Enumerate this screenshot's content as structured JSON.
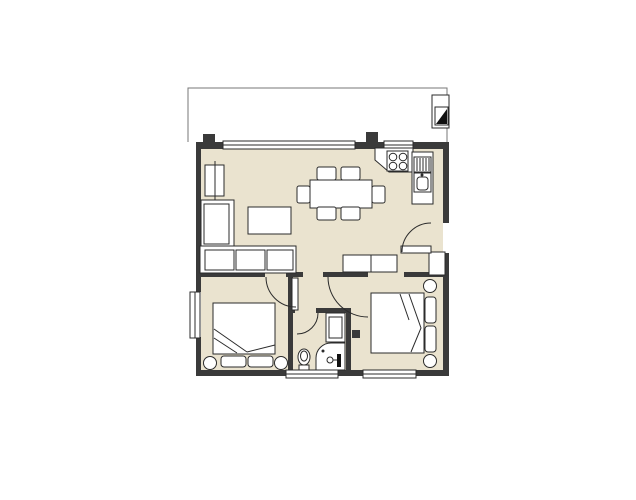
{
  "meta": {
    "type": "architectural-floor-plan",
    "rooms": [
      "living-dining-room",
      "kitchen",
      "hallway",
      "bedroom-left",
      "bedroom-right",
      "bathroom",
      "balcony"
    ]
  },
  "colors": {
    "floor": "#eae3cf",
    "wall": "#3a3a3a",
    "line": "#2b2b2b",
    "soft": "#777777",
    "white": "#ffffff",
    "dark": "#111111"
  },
  "canvas": {
    "width": 636,
    "height": 500
  },
  "elements": [
    {
      "name": "floor-living-dining",
      "type": "rect",
      "x": 201,
      "y": 148,
      "w": 242,
      "h": 124,
      "fill": "floor"
    },
    {
      "name": "floor-hallway",
      "type": "rect",
      "x": 293,
      "y": 272,
      "w": 75,
      "h": 41,
      "fill": "floor"
    },
    {
      "name": "floor-door-gap-bedleft",
      "type": "rect",
      "x": 265,
      "y": 272,
      "w": 23,
      "h": 5,
      "fill": "floor"
    },
    {
      "name": "floor-door-gap-bedright",
      "type": "rect",
      "x": 368,
      "y": 272,
      "w": 36,
      "h": 5,
      "fill": "floor"
    },
    {
      "name": "floor-bedroom-left",
      "type": "rect",
      "x": 201,
      "y": 277,
      "w": 87,
      "h": 93,
      "fill": "floor"
    },
    {
      "name": "floor-bathroom",
      "type": "rect",
      "x": 293,
      "y": 308,
      "w": 53,
      "h": 62,
      "fill": "floor"
    },
    {
      "name": "floor-bedroom-right",
      "type": "rect",
      "x": 348,
      "y": 277,
      "w": 95,
      "h": 93,
      "fill": "floor"
    },
    {
      "name": "balcony-floor",
      "type": "rect",
      "x": 187,
      "y": 87,
      "w": 261,
      "h": 56,
      "fill": "white"
    },
    {
      "name": "balcony-outline",
      "type": "path",
      "d": "M188,142 L188,88 L447,88 L447,142",
      "stroke": "soft"
    },
    {
      "name": "wall-top-left",
      "type": "rect",
      "x": 196,
      "y": 142,
      "w": 27,
      "h": 7,
      "fill": "wall"
    },
    {
      "name": "wall-top-mid",
      "type": "rect",
      "x": 355,
      "y": 142,
      "w": 30,
      "h": 7,
      "fill": "wall"
    },
    {
      "name": "wall-top-right",
      "type": "rect",
      "x": 412,
      "y": 142,
      "w": 37,
      "h": 7,
      "fill": "wall"
    },
    {
      "name": "wall-pier-top-left",
      "type": "rect",
      "x": 203,
      "y": 134,
      "w": 12,
      "h": 8,
      "fill": "wall"
    },
    {
      "name": "wall-balcony-divider",
      "type": "rect",
      "x": 366,
      "y": 132,
      "w": 12,
      "h": 10,
      "fill": "wall"
    },
    {
      "name": "wall-left-upper",
      "type": "rect",
      "x": 196,
      "y": 142,
      "w": 5,
      "h": 150,
      "fill": "wall"
    },
    {
      "name": "wall-left-lower",
      "type": "rect",
      "x": 196,
      "y": 337,
      "w": 5,
      "h": 39,
      "fill": "wall"
    },
    {
      "name": "wall-bottom-1",
      "type": "rect",
      "x": 196,
      "y": 370,
      "w": 90,
      "h": 6,
      "fill": "wall"
    },
    {
      "name": "wall-bottom-2",
      "type": "rect",
      "x": 338,
      "y": 370,
      "w": 25,
      "h": 6,
      "fill": "wall"
    },
    {
      "name": "wall-bottom-3",
      "type": "rect",
      "x": 416,
      "y": 370,
      "w": 33,
      "h": 6,
      "fill": "wall"
    },
    {
      "name": "wall-right-upper",
      "type": "rect",
      "x": 443,
      "y": 142,
      "w": 6,
      "h": 81,
      "fill": "wall"
    },
    {
      "name": "wall-right-lower",
      "type": "rect",
      "x": 443,
      "y": 253,
      "w": 6,
      "h": 123,
      "fill": "wall"
    },
    {
      "name": "wall-under-sofa",
      "type": "rect",
      "x": 198,
      "y": 272,
      "w": 67,
      "h": 5,
      "fill": "wall"
    },
    {
      "name": "wall-stub-center",
      "type": "rect",
      "x": 286,
      "y": 272,
      "w": 17,
      "h": 5,
      "fill": "wall"
    },
    {
      "name": "wall-bedleft-east",
      "type": "rect",
      "x": 288,
      "y": 277,
      "w": 5,
      "h": 99,
      "fill": "wall"
    },
    {
      "name": "wall-hall-south",
      "type": "rect",
      "x": 323,
      "y": 272,
      "w": 45,
      "h": 5,
      "fill": "wall"
    },
    {
      "name": "wall-hall-south-right",
      "type": "rect",
      "x": 404,
      "y": 272,
      "w": 45,
      "h": 5,
      "fill": "wall"
    },
    {
      "name": "wall-bath-top",
      "type": "rect",
      "x": 316,
      "y": 308,
      "w": 35,
      "h": 5,
      "fill": "wall"
    },
    {
      "name": "wall-bath-east",
      "type": "rect",
      "x": 346,
      "y": 308,
      "w": 5,
      "h": 68,
      "fill": "wall"
    },
    {
      "name": "wall-bath-stub",
      "type": "rect",
      "x": 288,
      "y": 304,
      "w": 7,
      "h": 9,
      "fill": "wall"
    },
    {
      "name": "wall-switch-mark",
      "type": "rect",
      "x": 352,
      "y": 330,
      "w": 8,
      "h": 8,
      "fill": "wall"
    },
    {
      "name": "window-balcony-main",
      "type": "rect",
      "x": 223,
      "y": 141,
      "w": 132,
      "h": 8,
      "fill": "white",
      "stroke": "line"
    },
    {
      "name": "window-balcony-main-midline",
      "type": "line",
      "x1": 223,
      "y1": 145,
      "x2": 355,
      "y2": 145,
      "stroke": "line"
    },
    {
      "name": "window-balcony-kitchen",
      "type": "rect",
      "x": 384,
      "y": 141,
      "w": 29,
      "h": 8,
      "fill": "white",
      "stroke": "line"
    },
    {
      "name": "window-balcony-kitchen-midline",
      "type": "line",
      "x1": 384,
      "y1": 145,
      "x2": 413,
      "y2": 145,
      "stroke": "line"
    },
    {
      "name": "window-bedleft-west",
      "type": "rect",
      "x": 190,
      "y": 292,
      "w": 10,
      "h": 46,
      "fill": "white",
      "stroke": "line"
    },
    {
      "name": "window-bedleft-west-midline",
      "type": "line",
      "x1": 195,
      "y1": 292,
      "x2": 195,
      "y2": 338,
      "stroke": "line"
    },
    {
      "name": "window-bath-south",
      "type": "rect",
      "x": 286,
      "y": 370,
      "w": 52,
      "h": 8,
      "fill": "white",
      "stroke": "line"
    },
    {
      "name": "window-bath-south-midline",
      "type": "line",
      "x1": 286,
      "y1": 374,
      "x2": 338,
      "y2": 374,
      "stroke": "line"
    },
    {
      "name": "window-bedright-south",
      "type": "rect",
      "x": 363,
      "y": 370,
      "w": 53,
      "h": 8,
      "fill": "white",
      "stroke": "line"
    },
    {
      "name": "window-bedright-south-midline",
      "type": "line",
      "x1": 363,
      "y1": 374,
      "x2": 416,
      "y2": 374,
      "stroke": "line"
    },
    {
      "name": "shaft-box",
      "type": "rect",
      "x": 432,
      "y": 95,
      "w": 17,
      "h": 33,
      "fill": "white",
      "stroke": "line"
    },
    {
      "name": "shaft-inner",
      "type": "rect",
      "x": 435,
      "y": 107,
      "w": 13,
      "h": 18,
      "fill": "white",
      "stroke": "line"
    },
    {
      "name": "shaft-triangle",
      "type": "polygon",
      "points": "436,124 447,124 447,109",
      "fill": "dark"
    },
    {
      "name": "kitchen-counter-top",
      "type": "polygon",
      "points": "375,148 413,148 413,172 389,172 375,160",
      "fill": "white",
      "stroke": "line"
    },
    {
      "name": "stove",
      "type": "rect",
      "x": 387,
      "y": 151,
      "w": 21,
      "h": 20,
      "fill": "white",
      "stroke": "line"
    },
    {
      "name": "stove-burner-1",
      "type": "circle",
      "cx": 393,
      "cy": 157,
      "r": 3.8,
      "stroke": "line"
    },
    {
      "name": "stove-burner-2",
      "type": "circle",
      "cx": 403,
      "cy": 157,
      "r": 3.8,
      "stroke": "line"
    },
    {
      "name": "stove-burner-3",
      "type": "circle",
      "cx": 393,
      "cy": 166,
      "r": 3.8,
      "stroke": "line"
    },
    {
      "name": "stove-burner-4",
      "type": "circle",
      "cx": 403,
      "cy": 166,
      "r": 3.8,
      "stroke": "line"
    },
    {
      "name": "kitchen-counter-side",
      "type": "rect",
      "x": 412,
      "y": 152,
      "w": 21,
      "h": 52,
      "fill": "white",
      "stroke": "line"
    },
    {
      "name": "drainer",
      "type": "rect",
      "x": 414,
      "y": 157,
      "w": 17,
      "h": 15,
      "fill": "white",
      "stroke": "line"
    },
    {
      "name": "drainer-ribs",
      "type": "path",
      "d": "M417,158 V171 M420,158 V171 M423,158 V171 M426,158 V171 M429,158 V171",
      "stroke": "line"
    },
    {
      "name": "kitchen-sink",
      "type": "rect",
      "x": 414,
      "y": 173,
      "w": 17,
      "h": 19,
      "fill": "white",
      "stroke": "line"
    },
    {
      "name": "kitchen-sink-basin",
      "type": "rect",
      "x": 417,
      "y": 177,
      "w": 11,
      "h": 13,
      "rx": 3,
      "fill": "white",
      "stroke": "line"
    },
    {
      "name": "kitchen-sink-faucet",
      "type": "circle",
      "cx": 422,
      "cy": 175,
      "r": 1.5,
      "fill": "line"
    },
    {
      "name": "dining-table",
      "type": "rect",
      "x": 310,
      "y": 180,
      "w": 62,
      "h": 28,
      "fill": "white",
      "stroke": "line"
    },
    {
      "name": "dining-chair-top-1",
      "type": "rect",
      "x": 317,
      "y": 167,
      "w": 19,
      "h": 13,
      "rx": 2,
      "fill": "white",
      "stroke": "line"
    },
    {
      "name": "dining-chair-top-2",
      "type": "rect",
      "x": 341,
      "y": 167,
      "w": 19,
      "h": 13,
      "rx": 2,
      "fill": "white",
      "stroke": "line"
    },
    {
      "name": "dining-chair-bottom-1",
      "type": "rect",
      "x": 317,
      "y": 207,
      "w": 19,
      "h": 13,
      "rx": 2,
      "fill": "white",
      "stroke": "line"
    },
    {
      "name": "dining-chair-bottom-2",
      "type": "rect",
      "x": 341,
      "y": 207,
      "w": 19,
      "h": 13,
      "rx": 2,
      "fill": "white",
      "stroke": "line"
    },
    {
      "name": "dining-chair-left",
      "type": "rect",
      "x": 297,
      "y": 186,
      "w": 13,
      "h": 17,
      "rx": 2,
      "fill": "white",
      "stroke": "line"
    },
    {
      "name": "dining-chair-right",
      "type": "rect",
      "x": 372,
      "y": 186,
      "w": 13,
      "h": 17,
      "rx": 2,
      "fill": "white",
      "stroke": "line"
    },
    {
      "name": "tv-board",
      "type": "rect",
      "x": 205,
      "y": 165,
      "w": 19,
      "h": 31,
      "fill": "white",
      "stroke": "line"
    },
    {
      "name": "tv-board-line",
      "type": "line",
      "x1": 215,
      "y1": 161,
      "x2": 215,
      "y2": 200,
      "stroke": "line"
    },
    {
      "name": "sofa-chaise",
      "type": "rect",
      "x": 201,
      "y": 200,
      "w": 33,
      "h": 47,
      "fill": "white",
      "stroke": "line"
    },
    {
      "name": "sofa-chaise-cushion",
      "type": "rect",
      "x": 204,
      "y": 204,
      "w": 25,
      "h": 40,
      "fill": "white",
      "stroke": "line"
    },
    {
      "name": "sofa-body",
      "type": "rect",
      "x": 200,
      "y": 246,
      "w": 96,
      "h": 27,
      "fill": "white",
      "stroke": "line"
    },
    {
      "name": "sofa-cushion-1",
      "type": "rect",
      "x": 205,
      "y": 250,
      "w": 29,
      "h": 20,
      "fill": "white",
      "stroke": "line"
    },
    {
      "name": "sofa-cushion-2",
      "type": "rect",
      "x": 236,
      "y": 250,
      "w": 29,
      "h": 20,
      "fill": "white",
      "stroke": "line"
    },
    {
      "name": "sofa-cushion-3",
      "type": "rect",
      "x": 267,
      "y": 250,
      "w": 26,
      "h": 20,
      "fill": "white",
      "stroke": "line"
    },
    {
      "name": "coffee-table",
      "type": "rect",
      "x": 248,
      "y": 207,
      "w": 43,
      "h": 27,
      "fill": "white",
      "stroke": "line"
    },
    {
      "name": "sideboard",
      "type": "rect",
      "x": 343,
      "y": 255,
      "w": 54,
      "h": 17,
      "fill": "white",
      "stroke": "line"
    },
    {
      "name": "sideboard-divider",
      "type": "line",
      "x1": 371,
      "y1": 255,
      "x2": 371,
      "y2": 272,
      "stroke": "line"
    },
    {
      "name": "entry-wall-pier",
      "type": "rect",
      "x": 429,
      "y": 252,
      "w": 16,
      "h": 23,
      "fill": "white",
      "stroke": "line"
    },
    {
      "name": "entry-door-leaf",
      "type": "rect",
      "x": 401,
      "y": 246,
      "w": 30,
      "h": 7,
      "fill": "white",
      "stroke": "line"
    },
    {
      "name": "entry-door-arc",
      "type": "path",
      "d": "M402,252 A29,29 0 0 1 431,223",
      "stroke": "line"
    },
    {
      "name": "door-bedleft-leaf",
      "type": "rect",
      "x": 292,
      "y": 278,
      "w": 6,
      "h": 32,
      "fill": "white",
      "stroke": "line"
    },
    {
      "name": "door-bedleft-arc",
      "type": "path",
      "d": "M266,277 A30,30 0 0 0 296,307",
      "stroke": "line"
    },
    {
      "name": "door-bedright-arc",
      "type": "path",
      "d": "M328,277 A40,40 0 0 0 368,317",
      "stroke": "line"
    },
    {
      "name": "door-bath-arc",
      "type": "path",
      "d": "M318,313 A21,21 0 0 1 297,334",
      "stroke": "line"
    },
    {
      "name": "bed-left",
      "type": "rect",
      "x": 213,
      "y": 303,
      "w": 62,
      "h": 51,
      "fill": "white",
      "stroke": "line"
    },
    {
      "name": "bed-left-blanket-fold",
      "type": "path",
      "d": "M214,329 L247,352 M214,338 L237,353 M247,352 L275,345",
      "stroke": "line"
    },
    {
      "name": "bed-left-pillow-1",
      "type": "rect",
      "x": 221,
      "y": 356,
      "w": 25,
      "h": 11,
      "rx": 3,
      "fill": "white",
      "stroke": "line"
    },
    {
      "name": "bed-left-pillow-2",
      "type": "rect",
      "x": 248,
      "y": 356,
      "w": 25,
      "h": 11,
      "rx": 3,
      "fill": "white",
      "stroke": "line"
    },
    {
      "name": "nightstand-left-1",
      "type": "circle",
      "cx": 210,
      "cy": 363,
      "r": 6.5,
      "fill": "white",
      "stroke": "line"
    },
    {
      "name": "nightstand-left-2",
      "type": "circle",
      "cx": 281,
      "cy": 363,
      "r": 6.5,
      "fill": "white",
      "stroke": "line"
    },
    {
      "name": "bed-right",
      "type": "rect",
      "x": 371,
      "y": 293,
      "w": 53,
      "h": 60,
      "fill": "white",
      "stroke": "line"
    },
    {
      "name": "bed-right-blanket-fold",
      "type": "path",
      "d": "M409,294 L421,328 L411,352 M400,294 L409,320",
      "stroke": "line"
    },
    {
      "name": "bed-right-pillow-1",
      "type": "rect",
      "x": 425,
      "y": 297,
      "w": 11,
      "h": 26,
      "rx": 3,
      "fill": "white",
      "stroke": "line"
    },
    {
      "name": "bed-right-pillow-2",
      "type": "rect",
      "x": 425,
      "y": 326,
      "w": 11,
      "h": 26,
      "rx": 3,
      "fill": "white",
      "stroke": "line"
    },
    {
      "name": "nightstand-right-1",
      "type": "circle",
      "cx": 430,
      "cy": 286,
      "r": 6.5,
      "fill": "white",
      "stroke": "line"
    },
    {
      "name": "nightstand-right-2",
      "type": "circle",
      "cx": 430,
      "cy": 361,
      "r": 6.5,
      "fill": "white",
      "stroke": "line"
    },
    {
      "name": "washbasin-cabinet",
      "type": "rect",
      "x": 326,
      "y": 313,
      "w": 19,
      "h": 29,
      "fill": "white",
      "stroke": "line"
    },
    {
      "name": "washbasin-inner",
      "type": "rect",
      "x": 329,
      "y": 317,
      "w": 13,
      "h": 21,
      "fill": "white",
      "stroke": "line"
    },
    {
      "name": "shower-tray",
      "type": "path",
      "d": "M345,343 L331,343 A15,15 0 0 0 316,358 L316,370 L345,370 Z",
      "fill": "white",
      "stroke": "line"
    },
    {
      "name": "shower-drain",
      "type": "circle",
      "cx": 323,
      "cy": 351,
      "r": 1.5,
      "fill": "line"
    },
    {
      "name": "shower-mixer",
      "type": "circle",
      "cx": 330,
      "cy": 360,
      "r": 3,
      "stroke": "line"
    },
    {
      "name": "shower-mixer-stem",
      "type": "line",
      "x1": 333,
      "y1": 360,
      "x2": 338,
      "y2": 360,
      "stroke": "line"
    },
    {
      "name": "shower-panel",
      "type": "rect",
      "x": 337,
      "y": 354,
      "w": 4,
      "h": 13,
      "fill": "dark"
    },
    {
      "name": "toilet-bowl",
      "type": "ellipse",
      "cx": 304,
      "cy": 357,
      "rx": 6,
      "ry": 8,
      "fill": "white",
      "stroke": "line"
    },
    {
      "name": "toilet-seat",
      "type": "ellipse",
      "cx": 304,
      "cy": 356,
      "rx": 3.5,
      "ry": 5,
      "fill": "none",
      "stroke": "line"
    },
    {
      "name": "toilet-tank",
      "type": "rect",
      "x": 299,
      "y": 365,
      "w": 10,
      "h": 5,
      "fill": "white",
      "stroke": "line"
    }
  ]
}
